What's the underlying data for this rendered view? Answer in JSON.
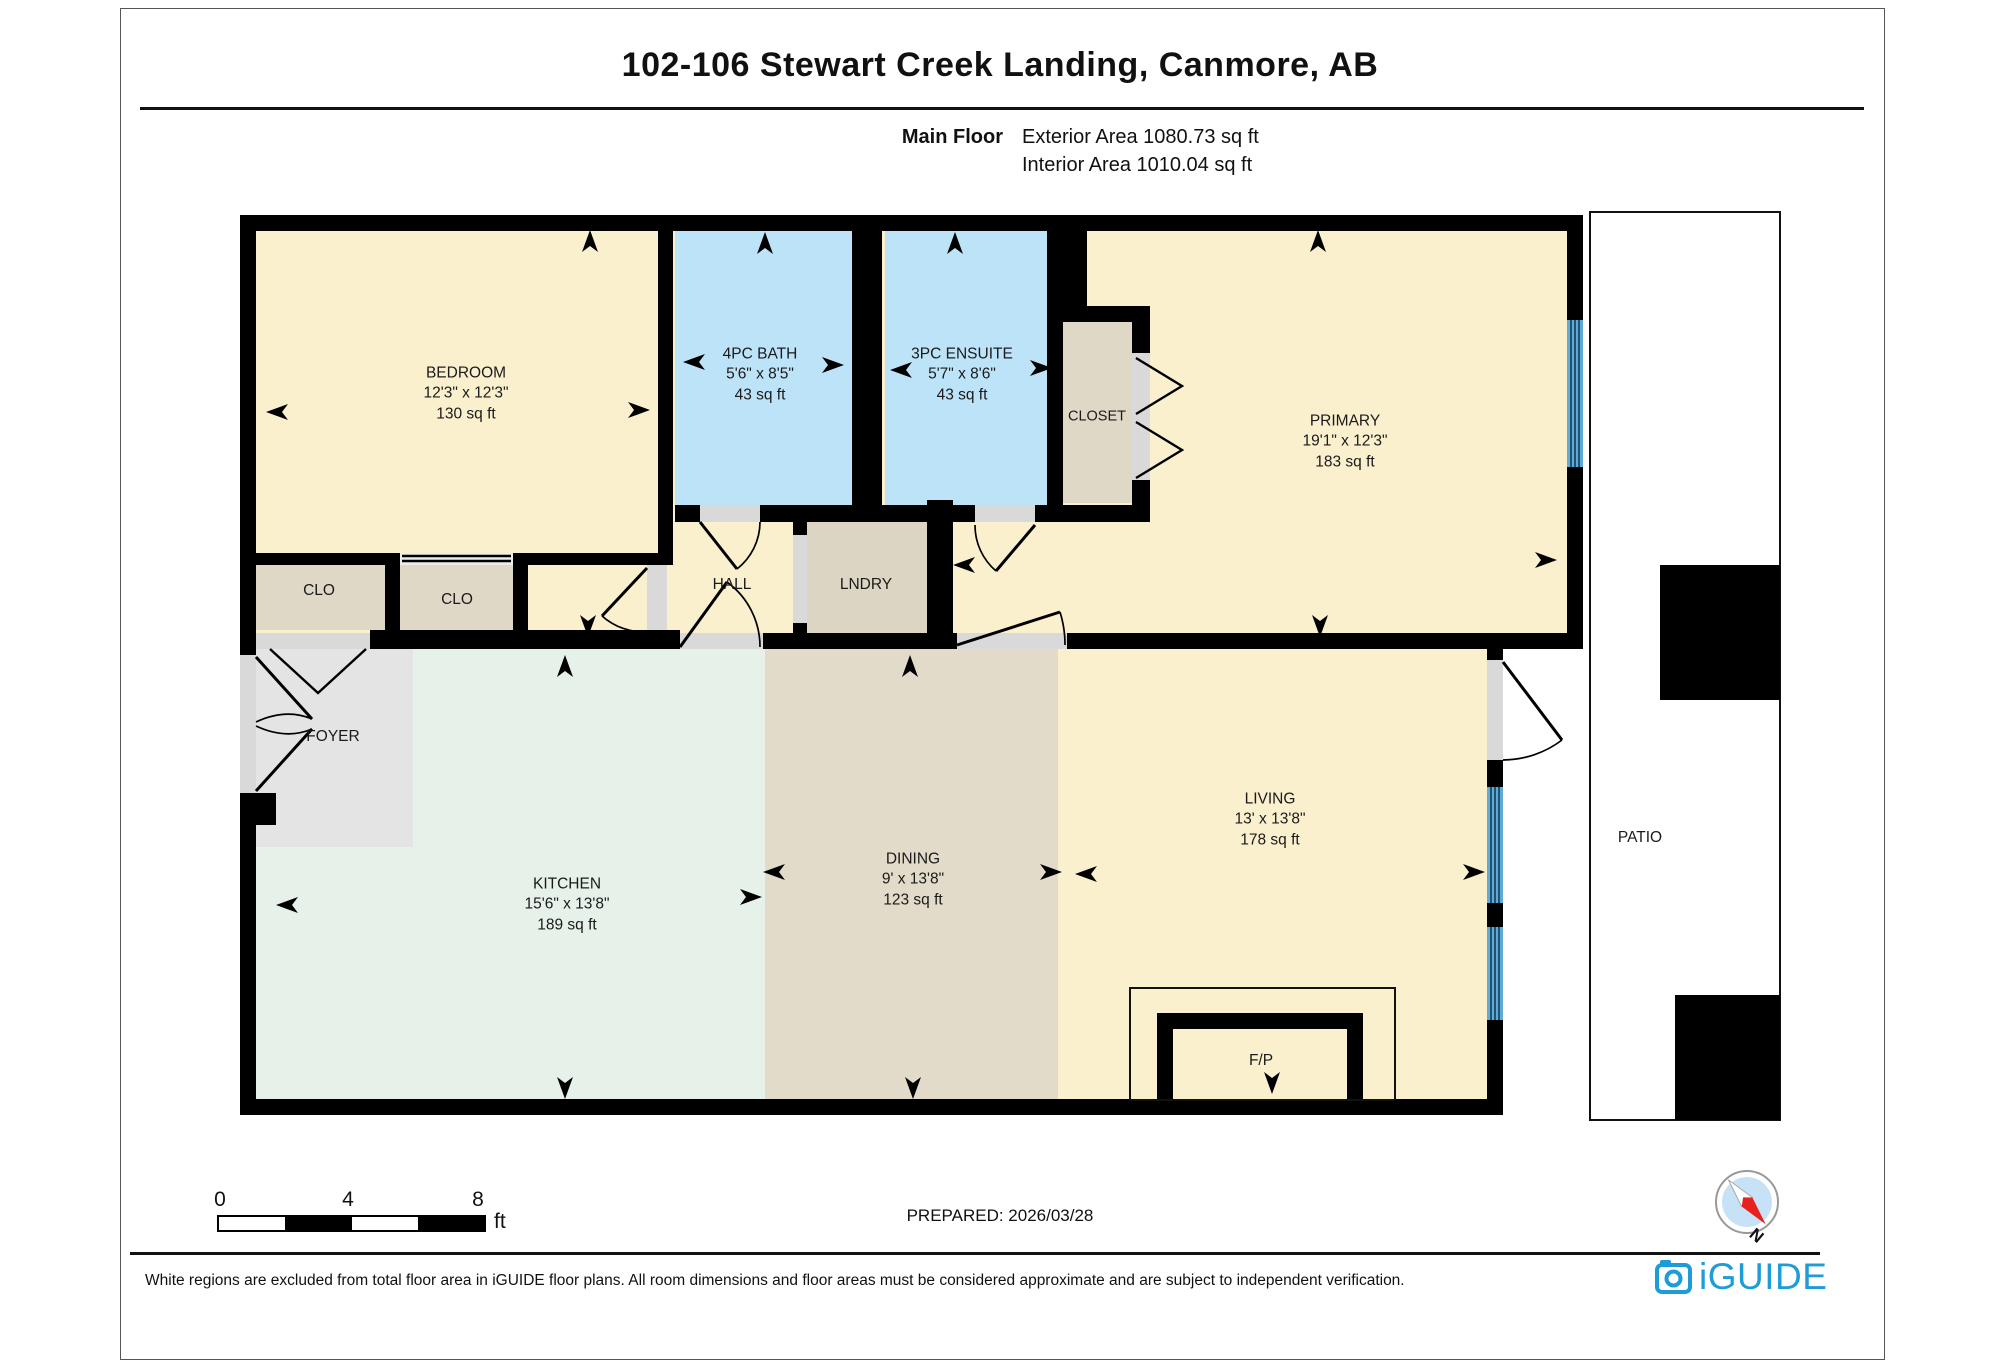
{
  "header": {
    "title": "102-106 Stewart Creek Landing, Canmore, AB",
    "floor_label": "Main Floor",
    "exterior_area": "Exterior Area 1080.73 sq ft",
    "interior_area": "Interior Area 1010.04 sq ft"
  },
  "rooms": [
    {
      "name": "BEDROOM",
      "dims": "12'3\" x 12'3\"",
      "area": "130 sq ft"
    },
    {
      "name": "4PC BATH",
      "dims": "5'6\" x 8'5\"",
      "area": "43 sq ft"
    },
    {
      "name": "3PC ENSUITE",
      "dims": "5'7\" x 8'6\"",
      "area": "43 sq ft"
    },
    {
      "name": "CLOSET"
    },
    {
      "name": "PRIMARY",
      "dims": "19'1\" x 12'3\"",
      "area": "183 sq ft"
    },
    {
      "name": "CLO"
    },
    {
      "name": "CLO"
    },
    {
      "name": "HALL"
    },
    {
      "name": "LNDRY"
    },
    {
      "name": "FOYER"
    },
    {
      "name": "KITCHEN",
      "dims": "15'6\" x 13'8\"",
      "area": "189 sq ft"
    },
    {
      "name": "DINING",
      "dims": "9' x 13'8\"",
      "area": "123 sq ft"
    },
    {
      "name": "LIVING",
      "dims": "13' x 13'8\"",
      "area": "178 sq ft"
    },
    {
      "name": "F/P"
    },
    {
      "name": "PATIO"
    }
  ],
  "scale_bar": {
    "start": "0",
    "mid": "4",
    "end": "8",
    "unit": "ft"
  },
  "footer": {
    "prepared": "PREPARED: 2026/03/28",
    "disclaimer": "White regions are excluded from total floor area in iGUIDE floor plans. All room dimensions and floor areas must be considered approximate and are subject to independent verification.",
    "brand": "iGUIDE",
    "compass_label": "N"
  },
  "colors": {
    "room_cream": "#FAF0CE",
    "bath_blue": "#BDE3F8",
    "closet_tan": "#E0D8C7",
    "dining_tan": "#E3DBCA",
    "kitchen_mint": "#E6F1E9",
    "foyer_gray": "#E4E4E4",
    "door_gray": "#D9D9D9",
    "window_blue": "#5FAAD6",
    "wall_black": "#000000",
    "brand_blue": "#1E9CD7",
    "compass_red": "#E8211D"
  }
}
